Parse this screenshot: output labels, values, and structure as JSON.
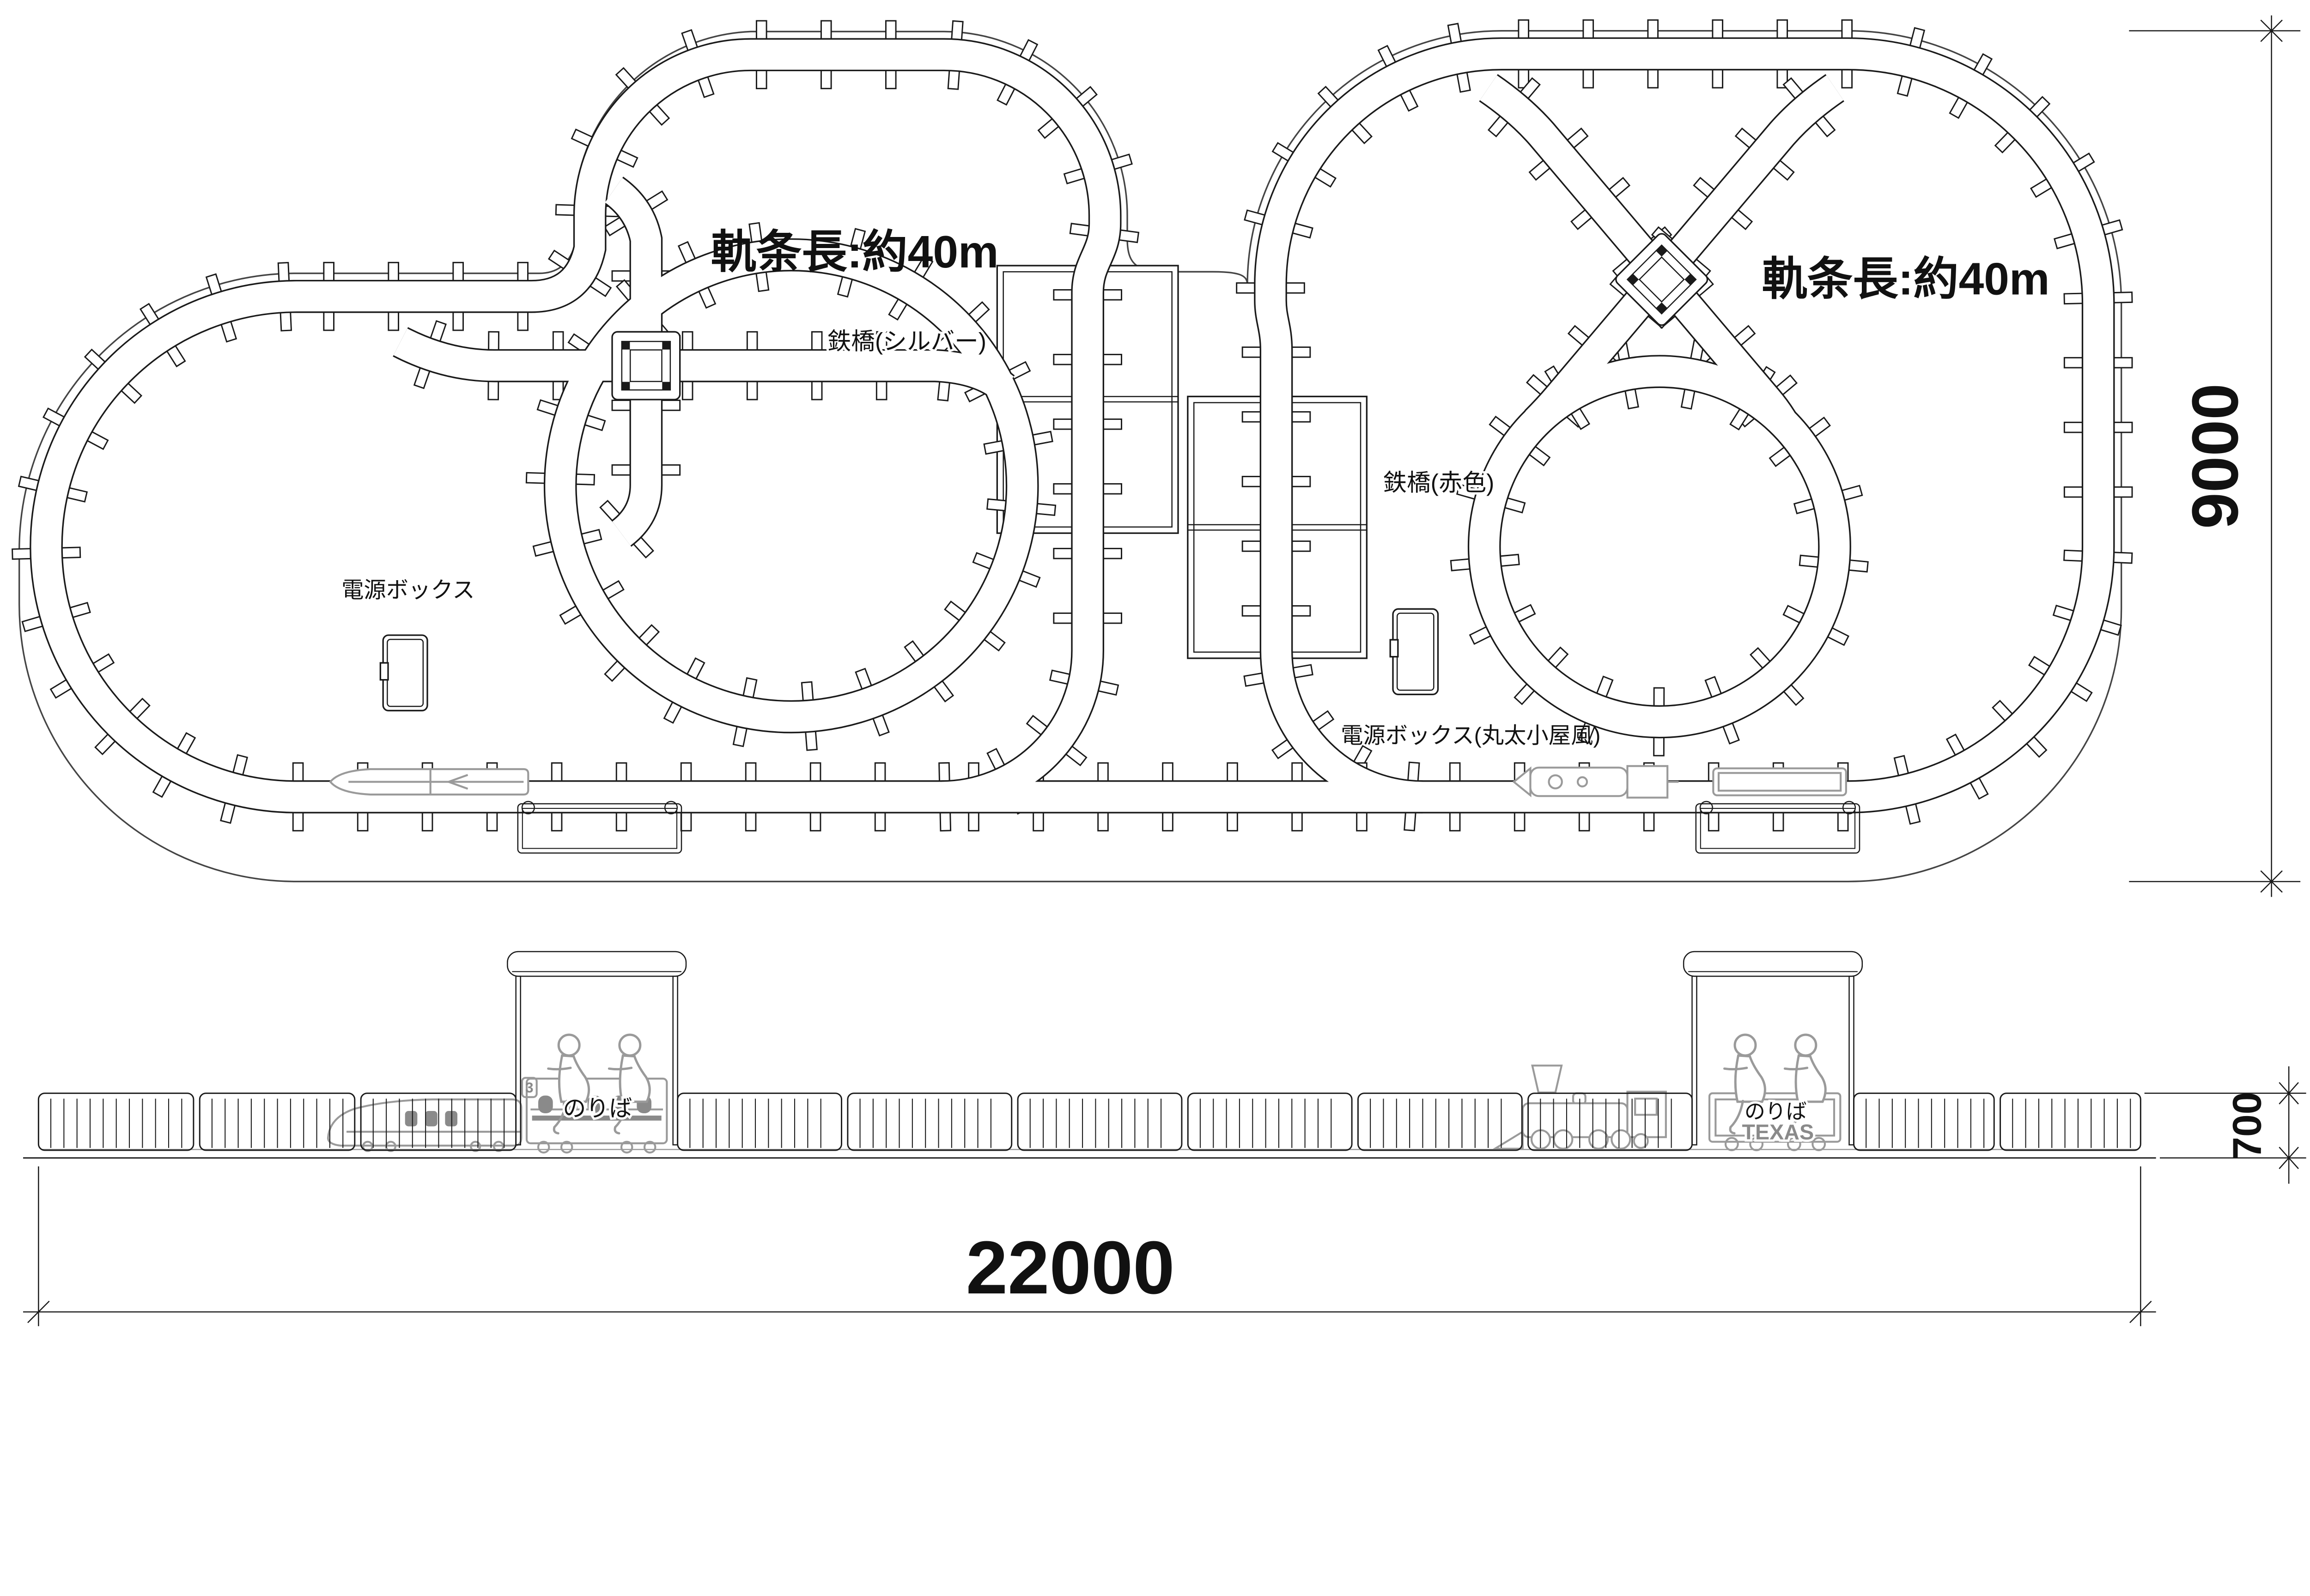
{
  "drawing": {
    "plan": {
      "left_rail_length_label": "軌条長:約40m",
      "right_rail_length_label": "軌条長:約40m",
      "silver_bridge_label": "鉄橋(シルバー)",
      "red_bridge_label": "鉄橋(赤色)",
      "power_box_label": "電源ボックス",
      "power_box_log_cabin_label": "電源ボックス(丸太小屋風)"
    },
    "elevation": {
      "left_platform_sign": "のりば",
      "right_platform_sign": "のりば",
      "locomotive_tender_label": "TEXAS",
      "train_car_number": "3"
    },
    "dimensions": {
      "site_length": "22000",
      "site_width": "9000",
      "fence_height": "700"
    },
    "colors": {
      "line": "#1a1a1a",
      "boundary": "#444444",
      "light_gray": "#9a9a9a",
      "mid_gray": "#8a8a8a"
    }
  }
}
